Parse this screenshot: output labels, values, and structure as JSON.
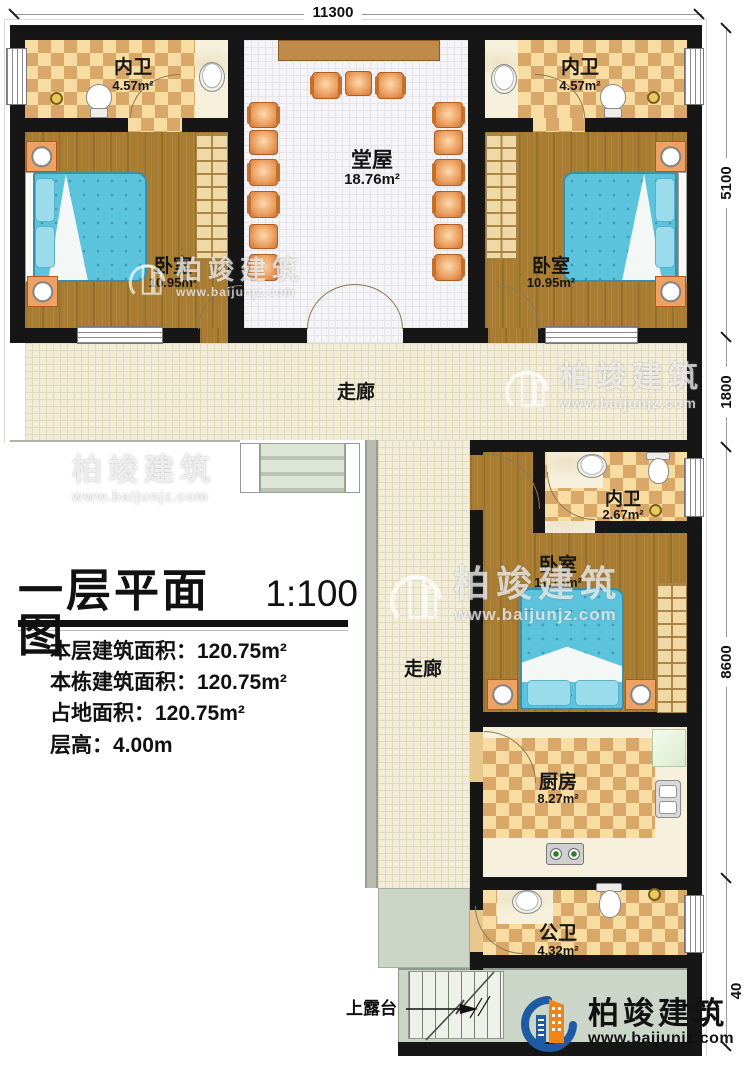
{
  "dimensions": {
    "top": "11300",
    "right": [
      {
        "label": "5100"
      },
      {
        "label": "1800"
      },
      {
        "label": "8600"
      },
      {
        "label": "40"
      }
    ]
  },
  "rooms": {
    "bath1": {
      "name": "内卫",
      "area": "4.57m²"
    },
    "bath2": {
      "name": "内卫",
      "area": "4.57m²"
    },
    "hall": {
      "name": "堂屋",
      "area": "18.76m²"
    },
    "bed1": {
      "name": "卧室",
      "area": "10.95m²"
    },
    "bed2": {
      "name": "卧室",
      "area": "10.95m²"
    },
    "corridor_h": {
      "name": "走廊"
    },
    "corridor_v": {
      "name": "走廊"
    },
    "bath3": {
      "name": "内卫",
      "area": "2.67m²"
    },
    "bed3": {
      "name": "卧室",
      "area": "11.13m²"
    },
    "kitchen": {
      "name": "厨房",
      "area": "8.27m²"
    },
    "bath4": {
      "name": "公卫",
      "area": "4.32m²"
    }
  },
  "title_block": {
    "title": "一层平面图",
    "scale": "1:100",
    "stats": [
      {
        "label": "本层建筑面积：",
        "value": "120.75m²"
      },
      {
        "label": "本栋建筑面积：",
        "value": "120.75m²"
      },
      {
        "label": "占地面积：",
        "value": "120.75m²"
      },
      {
        "label": "层高：",
        "value": "4.00m"
      }
    ]
  },
  "terrace": {
    "label": "上露台"
  },
  "watermark": {
    "brand": "柏竣建筑",
    "url": "www.baijunjz.com"
  },
  "logo": {
    "brand": "柏竣建筑",
    "url": "www.baijunjz.com"
  },
  "colors": {
    "wall": "#161616",
    "checker_dark": "#d9a768",
    "checker_light": "#f7dda2",
    "wood": "#a87c31",
    "bed_blue": "#5cc3dd",
    "furniture_orange": "#eda263",
    "logo_blue": "#1e5ba4",
    "logo_orange": "#f08419"
  }
}
